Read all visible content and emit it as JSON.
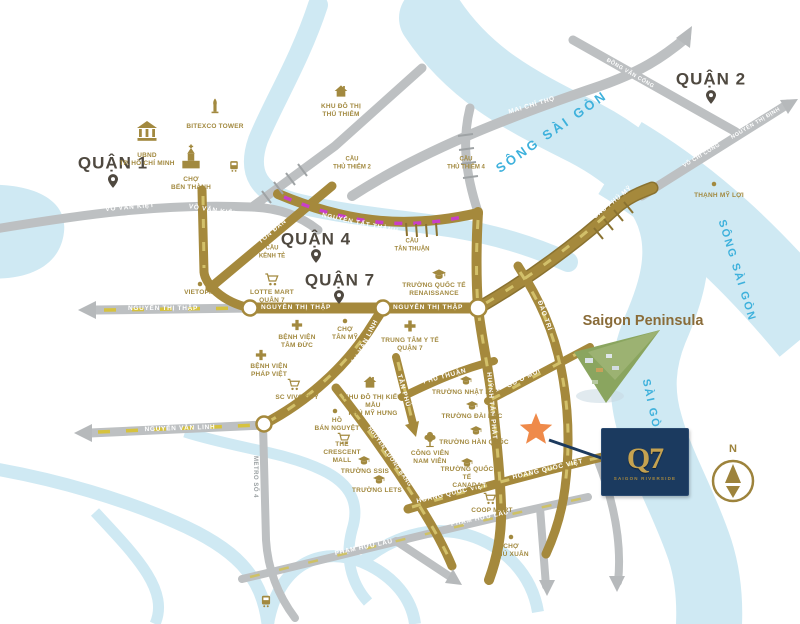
{
  "districts": {
    "d1": "QUẬN 1",
    "d2": "QUẬN 2",
    "d4": "QUẬN 4",
    "d7": "QUẬN 7"
  },
  "roads": {
    "vo_van_kiet": "VÕ VĂN KIỆT",
    "mai_chi_tho": "MAI CHÍ THỌ",
    "dong_van_cong": "ĐỒNG VĂN CỐNG",
    "vo_chi_cong": "VÕ CHÍ CÔNG",
    "nguyen_thi_dinh": "NGUYỄN THỊ ĐỊNH",
    "cau_phu_my": "CẦU PHÚ MỸ",
    "ton_dan": "TÔN ĐẢN",
    "nguyen_tat_thanh": "NGUYỄN TẤT THÀNH",
    "nguyen_thi_thap": "NGUYỄN THỊ THẬP",
    "nguyen_van_linh": "NGUYỄN VĂN LINH",
    "huynh_tan_phat": "HUỲNH TẤN PHÁT",
    "dao_tri": "ĐÀO TRÍ",
    "phu_thuan": "PHÚ THUẬN",
    "go_o_moi": "GÒ Ô MÔI",
    "tan_phu": "TÂN PHÚ",
    "nguyen_luong_bang": "NGUYỄN LƯƠNG BẰNG",
    "hoang_quoc_viet": "HOÀNG QUỐC VIỆT",
    "pham_huu_lau": "PHẠM HỮU LẦU",
    "metro_so_4": "METRO SỐ 4"
  },
  "bridges": {
    "thu_thiem_2": [
      "CẦU",
      "THỦ THIÊM 2"
    ],
    "thu_thiem_4": [
      "CẦU",
      "THỦ THIÊM 4"
    ],
    "tan_thuan": [
      "CẦU",
      "TÂN THUẬN"
    ],
    "kenh_te": [
      "CẦU",
      "KÊNH TẺ"
    ]
  },
  "landmarks": {
    "ubnd": {
      "label": [
        "UBND",
        "TP. HỒ CHÍ MINH"
      ]
    },
    "bitexco": {
      "label": "BITEXCO TOWER"
    },
    "ben_thanh": {
      "label": [
        "CHỢ",
        "BẾN THÀNH"
      ]
    },
    "thu_thiem_urban": {
      "label": [
        "KHU ĐÔ THỊ",
        "THỦ THIÊM"
      ]
    },
    "thanh_my_loi": {
      "label": "THẠNH MỸ LỢI"
    },
    "lotte_mart": {
      "label": [
        "LOTTE MART",
        "QUẬN 7"
      ]
    },
    "vietopia": {
      "label": "VIETOPIA"
    },
    "renaissance": {
      "label": [
        "TRƯỜNG QUỐC TẾ",
        "RENAISSANCE"
      ]
    },
    "cho_tan_my": {
      "label": [
        "CHỢ",
        "TÂN MỸ"
      ]
    },
    "trung_tam_y_te": {
      "label": [
        "TRUNG TÂM Y TẾ",
        "QUẬN 7"
      ]
    },
    "benh_vien_tam_duc": {
      "label": [
        "BỆNH VIỆN",
        "TÂM ĐỨC"
      ]
    },
    "benh_vien_phap_viet": {
      "label": [
        "BỆNH VIỆN",
        "PHÁP VIỆT"
      ]
    },
    "sc_vivocity": {
      "label": "SC VIVOCITY"
    },
    "phu_my_hung": {
      "label": [
        "KHU ĐÔ THỊ KIỂU MẪU",
        "PHÚ MỸ HƯNG"
      ]
    },
    "ho_ban_nguyet": {
      "label": [
        "HỒ",
        "BÁN NGUYỆT"
      ]
    },
    "crescent_mall": {
      "label": [
        "THE",
        "CRESCENT MALL"
      ]
    },
    "truong_ssis": {
      "label": "TRƯỜNG SSIS"
    },
    "truong_lets": {
      "label": "TRƯỜNG LETS"
    },
    "cong_vien_nam_vien": {
      "label": [
        "CÔNG VIÊN",
        "NAM VIÊN"
      ]
    },
    "truong_han_quoc": {
      "label": "TRƯỜNG HÀN QUỐC"
    },
    "truong_canada": {
      "label": [
        "TRƯỜNG QUỐC TẾ",
        "CANADA"
      ]
    },
    "coop_mart": {
      "label": "COOP MART"
    },
    "cho_phu_xuan": {
      "label": [
        "CHỢ",
        "PHÚ XUÂN"
      ]
    },
    "truong_nhat_ban": {
      "label": "TRƯỜNG NHẬT BẢN"
    },
    "truong_dai_bac": {
      "label": "TRƯỜNG ĐÀI BẮC"
    }
  },
  "rivers": {
    "song_sai_gon": "SÔNG SÀI GÒN",
    "sai_gon": "SÀI GÒN"
  },
  "peninsula_label": "Saigon Peninsula",
  "project": {
    "logo": "Q7",
    "tagline": "SAIGON RIVERSIDE"
  },
  "compass": {
    "north": "N"
  },
  "colors": {
    "gold_road": "#a5893c",
    "gray_road": "#bdc0c2",
    "river": "#cfe9f3",
    "river_text": "#3eb1dc",
    "landmark_gold": "#a2893f",
    "star": "#ef8a4a",
    "logo_bg": "#1b3a5f",
    "magenta_dash": "#c93fc9",
    "yellow_dash": "#d6c23e"
  }
}
